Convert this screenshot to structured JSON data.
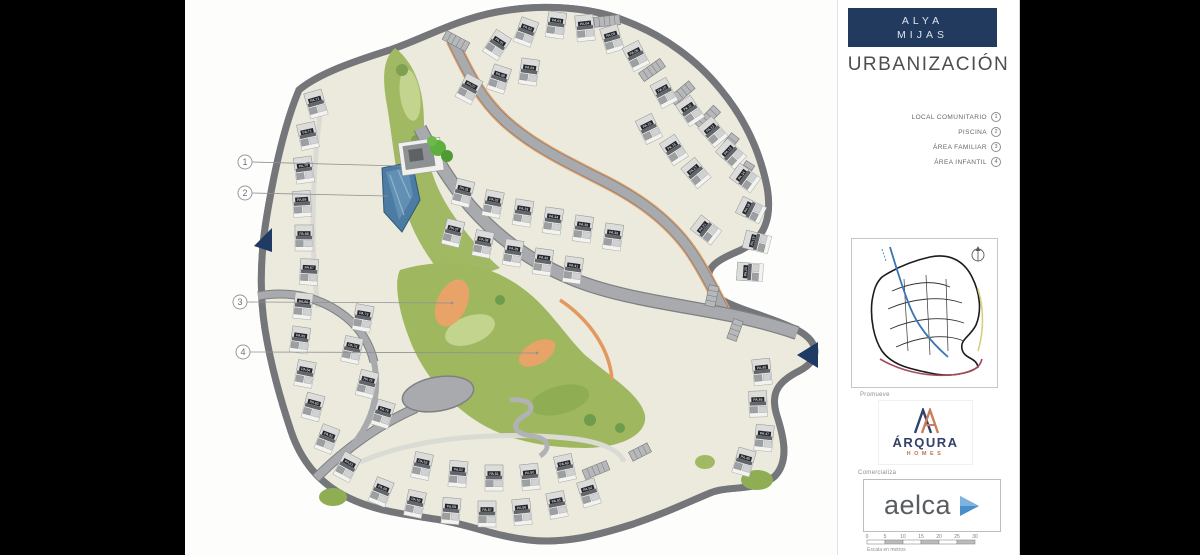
{
  "sidebar": {
    "brand": {
      "line1": "ALYA",
      "line2": "MIJAS"
    },
    "title": "URBANIZACIÓN",
    "legend": [
      {
        "label": "LOCAL COMUNITARIO",
        "num": "1"
      },
      {
        "label": "PISCINA",
        "num": "2"
      },
      {
        "label": "ÁREA FAMILIAR",
        "num": "3"
      },
      {
        "label": "ÁREA INFANTIL",
        "num": "4"
      }
    ],
    "promoter_label": "Promueve",
    "promoter": {
      "name": "ÁRQURA",
      "sub": "HOMES"
    },
    "seller_label": "Comercializa",
    "seller": {
      "name": "aelca"
    },
    "scalebar": {
      "ticks": [
        "0",
        "5",
        "10",
        "15",
        "20",
        "25",
        "30"
      ],
      "caption": "Escala en metros"
    }
  },
  "plan": {
    "callouts": [
      "1",
      "2",
      "3",
      "4"
    ],
    "plots": [
      "PA.72",
      "PA.71",
      "PA.70",
      "PA.69",
      "PA.68",
      "PA.67",
      "PA.66",
      "PA.65",
      "PA.64",
      "PA.63",
      "PA.62",
      "PA.61",
      "PA.60",
      "PA.59",
      "PA.58",
      "PA.57",
      "PA.56",
      "PA.55",
      "PA.54",
      "PA.53",
      "PA.52",
      "PA.51",
      "PA.50",
      "PA.49",
      "PA.73",
      "PA.74",
      "PA.75",
      "PA.76",
      "PA.01",
      "PA.02",
      "PA.03",
      "PA.04",
      "PA.05",
      "PA.06",
      "PA.07",
      "PA.08",
      "PA.09",
      "PA.10",
      "PA.11",
      "PA.12",
      "PA.13",
      "PA.14",
      "PA.15",
      "PA.16",
      "PA.17",
      "PA.18",
      "PA.19",
      "PA.20",
      "PA.21",
      "PA.31",
      "PA.32",
      "PA.33",
      "PA.34",
      "PA.35",
      "PA.36",
      "PA.37",
      "PA.38",
      "PA.39",
      "PA.40",
      "PA.41",
      "PA.45",
      "PA.46",
      "PA.47",
      "PA.48"
    ]
  },
  "colors": {
    "navy": "#223a5e",
    "cream": "#eceadc",
    "road": "#a8aaad",
    "road_edge": "#7e8083",
    "green": "#a2b964",
    "green_light": "#c2d48d",
    "green_dark": "#8fae54",
    "orange": "#e59f63",
    "pool_blue": "#4d7ca3",
    "coral": "#c0704f",
    "aelca_blue": "#5d9bd2"
  }
}
